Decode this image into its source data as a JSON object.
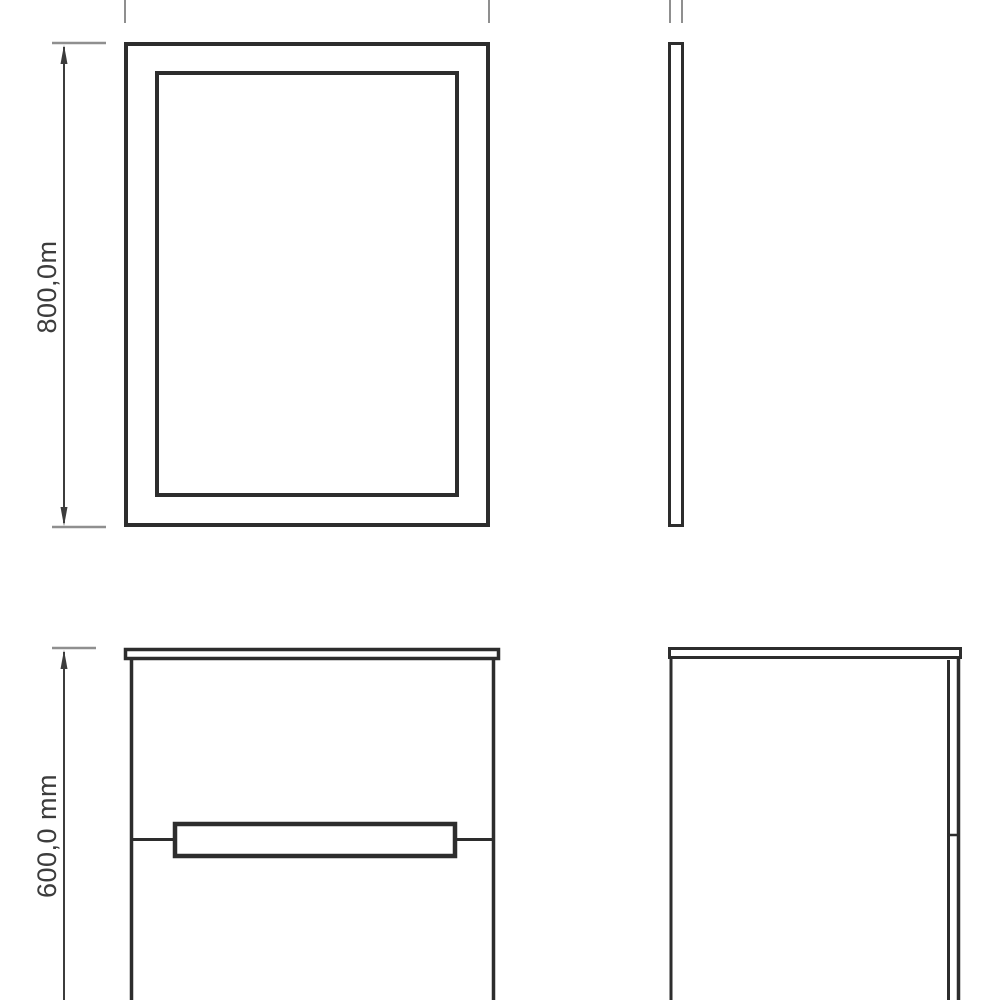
{
  "drawing": {
    "type": "furniture-technical-drawing",
    "colors": {
      "background": "#ffffff",
      "object_line": "#2d2d2d",
      "dimension_line": "#3c3c3c",
      "extension_line": "#8f8f8f",
      "text": "#3c3c3c"
    },
    "dimensions": {
      "mirror_height_label": "800,0m",
      "cabinet_height_label": "600,0 mm"
    }
  }
}
